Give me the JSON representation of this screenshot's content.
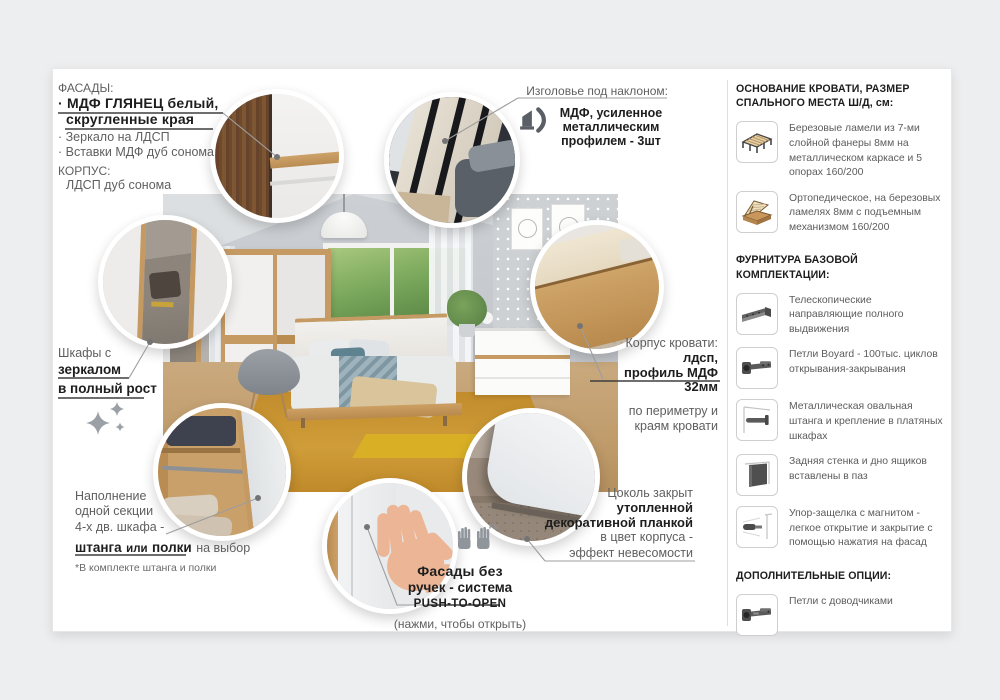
{
  "colors": {
    "page_bg": "#edeeef",
    "card_bg": "#ffffff",
    "oak": "#c59b63",
    "carpet": "#c8932f",
    "text_dark": "#1d1d1d",
    "text_gray": "#5c5c5c",
    "leader_line": "#9d9d9d",
    "underline_dark": "#3e3e3e"
  },
  "facades": {
    "title": "ФАСАДЫ:",
    "item1_line1": "· МДФ ГЛЯНЕЦ белый,",
    "item1_line2": "скругленные края",
    "item2": "· Зеркало на ЛДСП",
    "item3": "· Вставки МДФ дуб сонома",
    "korpus_title": "КОРПУС:",
    "korpus_value": "ЛДСП дуб сонома"
  },
  "headboard_note": {
    "title": "Изголовье под наклоном:",
    "icon": "tilted-headboard-icon",
    "bold_line1": "МДФ, усиленное",
    "bold_line2": "металлическим",
    "bold_line3": "профилем - 3шт"
  },
  "mirror_note": {
    "line1": "Шкафы с",
    "bold_line2": "зеркалом",
    "bold_line3": "в полный рост",
    "icon": "sparkles-icon"
  },
  "section_note": {
    "line1": "Наполнение",
    "line2": "одной секции",
    "line3": "4-х дв. шкафа -",
    "bold1": "штанга",
    "mid": "или",
    "bold2": "полки",
    "tail": "на выбор",
    "footnote": "*В комплекте штанга и полки"
  },
  "push_note": {
    "icon": "hands-icon",
    "bold_line1": "Фасады без",
    "bold_line2": "ручек - система",
    "bold_line3": "PUSH-TO-OPEN",
    "line4": "(нажми, чтобы открыть)"
  },
  "bedframe_note": {
    "line1": "Корпус кровати:",
    "bold1": "лдсп,",
    "bold2": "профиль МДФ 32мм",
    "line3": "по периметру и",
    "line4": "краям кровати"
  },
  "plinth_note": {
    "line1": "Цоколь закрыт",
    "bold1": "утопленной",
    "bold2": "декоративной планкой",
    "line3": "в цвет корпуса -",
    "line4": "эффект невесомости"
  },
  "sidebar": {
    "base_title": "ОСНОВАНИЕ КРОВАТИ, РАЗМЕР СПАЛЬНОГО МЕСТА Ш/Д, см:",
    "base_items": [
      {
        "icon": "slat-base-icon",
        "text": "Березовые ламели из 7-ми слойной фанеры 8мм на металлическом каркасе и 5 опорах 160/200"
      },
      {
        "icon": "lift-base-icon",
        "text": "Ортопедическое, на березовых ламелях 8мм с подъемным механизмом 160/200"
      }
    ],
    "hardware_title": "ФУРНИТУРА БАЗОВОЙ КОМПЛЕКТАЦИИ:",
    "hardware_items": [
      {
        "icon": "drawer-slide-icon",
        "text": "Телескопические направляющие полного выдвижения"
      },
      {
        "icon": "hinge-icon",
        "text": "Петли Boyard - 100тыс. циклов открывания-закрывания"
      },
      {
        "icon": "rod-icon",
        "text": "Металлическая овальная штанга и крепление  в платяных шкафах"
      },
      {
        "icon": "back-panel-icon",
        "text": "Задняя стенка и дно ящиков вставлены в паз"
      },
      {
        "icon": "magnet-latch-icon",
        "text": "Упор-защелка с магнитом - легкое  открытие и закрытие с помощью нажатия на фасад"
      }
    ],
    "options_title": "ДОПОЛНИТЕЛЬНЫЕ ОПЦИИ:",
    "options_items": [
      {
        "icon": "soft-close-hinge-icon",
        "text": "Петли с доводчиками"
      }
    ]
  }
}
